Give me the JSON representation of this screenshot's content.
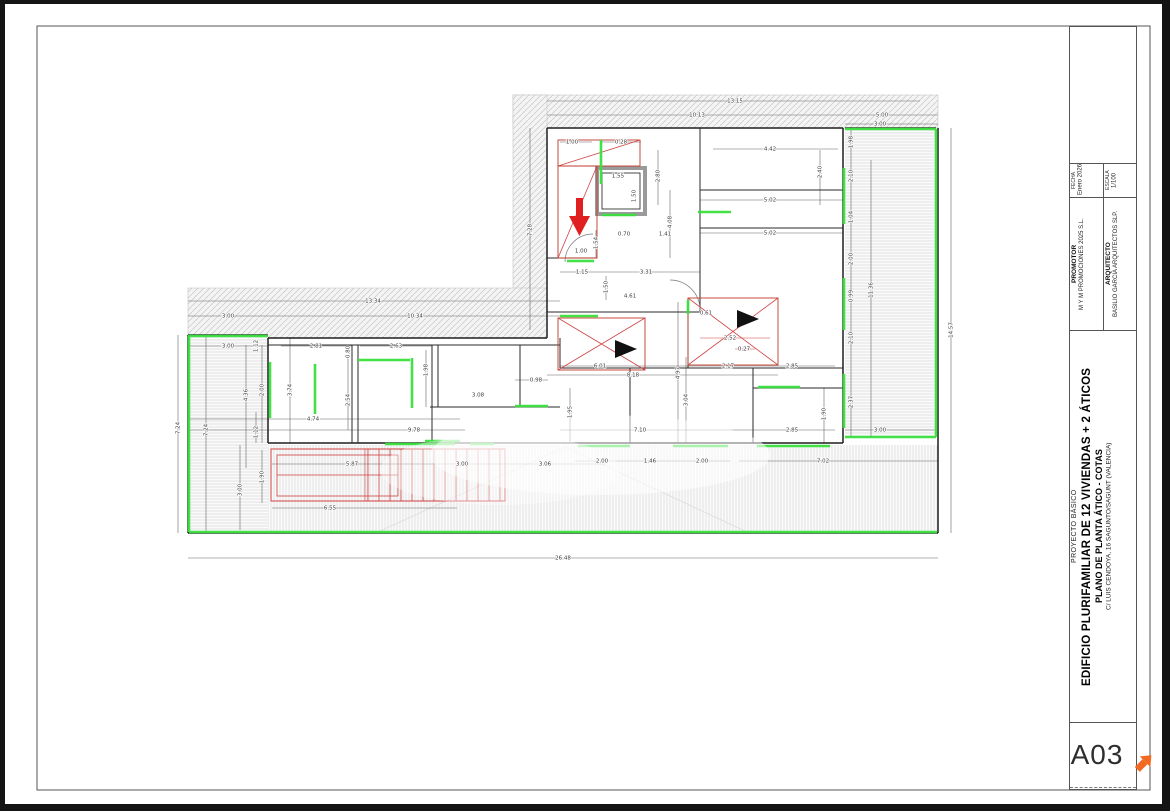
{
  "page": {
    "background": "#ffffff",
    "margin_color": "#141414",
    "frame_color": "#555555"
  },
  "title_block": {
    "fecha_label": "FECHA",
    "fecha_value": "Enero 2026",
    "escala_label": "ESCALA",
    "escala_value": "1/100",
    "promotor_label": "PROMOTOR",
    "promotor_value": "M Y M PROMOCIONES 2025 S.L.",
    "arquitecto_label": "ARQUITECTO",
    "arquitecto_value": "BASILIO GARCIA ARQUITECTOS SLP.",
    "proyecto_tipo": "PROYECTO BÁSICO",
    "proyecto_titulo": "EDIFICIO PLURIFAMILIAR DE 12 VIVIENDAS + 2 ÁTICOS",
    "plano_titulo": "PLANO DE PLANTA ÁTICO - COTAS",
    "direccion": "C/ LUIS CENDOYA, 16 SAGUNTO/SAGUNT (VALENCIA)",
    "sheet_number": "A03",
    "logo_color": "#f26a21"
  },
  "drawing": {
    "colors": {
      "highlight_green": "#38e03c",
      "stair_red": "#d04545",
      "arrow_red": "#e02020",
      "walls": "#1f1f1f",
      "hatch": "#cfcfcf"
    },
    "dimensions": [
      [
        735,
        101,
        "13.15",
        0
      ],
      [
        697,
        115,
        "10.13",
        0
      ],
      [
        882,
        115,
        "5.00",
        0
      ],
      [
        880,
        124,
        "3.00",
        0
      ],
      [
        530,
        230,
        "7.28",
        1
      ],
      [
        572,
        142,
        "1.00",
        0
      ],
      [
        621,
        142,
        "0.28",
        0
      ],
      [
        618,
        176,
        "1.55",
        0
      ],
      [
        634,
        196,
        "1.50",
        1
      ],
      [
        658,
        176,
        "2.80",
        1
      ],
      [
        670,
        222,
        "4.08",
        1
      ],
      [
        596,
        243,
        "1.54",
        1
      ],
      [
        581,
        251,
        "1.00",
        0
      ],
      [
        582,
        272,
        "1.15",
        0
      ],
      [
        646,
        272,
        "3.31",
        0
      ],
      [
        606,
        287,
        "1.50",
        1
      ],
      [
        630,
        296,
        "4.61",
        0
      ],
      [
        624,
        234,
        "0.70",
        0
      ],
      [
        665,
        234,
        "1.41",
        0
      ],
      [
        770,
        149,
        "4.42",
        0
      ],
      [
        770,
        200,
        "5.02",
        0
      ],
      [
        770,
        233,
        "5.02",
        0
      ],
      [
        820,
        172,
        "2.40",
        1
      ],
      [
        851,
        142,
        "1.98",
        1
      ],
      [
        851,
        176,
        "2.10",
        1
      ],
      [
        851,
        217,
        "1.04",
        1
      ],
      [
        851,
        259,
        "2.00",
        1
      ],
      [
        851,
        296,
        "0.99",
        1
      ],
      [
        851,
        338,
        "2.10",
        1
      ],
      [
        851,
        402,
        "2.37",
        1
      ],
      [
        871,
        290,
        "11.36",
        1
      ],
      [
        951,
        330,
        "14.57",
        1
      ],
      [
        880,
        430,
        "3.00",
        0
      ],
      [
        373,
        301,
        "13.34",
        0
      ],
      [
        228,
        316,
        "3.00",
        0
      ],
      [
        415,
        316,
        "10.34",
        0
      ],
      [
        228,
        346,
        "3.00",
        0
      ],
      [
        256,
        346,
        "1.12",
        1
      ],
      [
        316,
        346,
        "2.81",
        0
      ],
      [
        348,
        352,
        "0.80",
        1
      ],
      [
        396,
        346,
        "2.63",
        0
      ],
      [
        178,
        428,
        "7.24",
        1
      ],
      [
        206,
        430,
        "7.24",
        1
      ],
      [
        246,
        395,
        "4.36",
        1
      ],
      [
        262,
        390,
        "2.00",
        1
      ],
      [
        290,
        390,
        "3.74",
        1
      ],
      [
        348,
        400,
        "2.54",
        1
      ],
      [
        313,
        419,
        "4.74",
        0
      ],
      [
        414,
        430,
        "9.78",
        0
      ],
      [
        256,
        432,
        "1.12",
        1
      ],
      [
        262,
        477,
        "1.90",
        1
      ],
      [
        240,
        490,
        "3.00",
        1
      ],
      [
        352,
        464,
        "5.87",
        0
      ],
      [
        462,
        464,
        "3.00",
        0
      ],
      [
        545,
        464,
        "3.06",
        0
      ],
      [
        330,
        508,
        "6.55",
        0
      ],
      [
        563,
        558,
        "26.48",
        0
      ],
      [
        600,
        366,
        "6.01",
        0
      ],
      [
        728,
        366,
        "2.17",
        0
      ],
      [
        633,
        375,
        "8.18",
        0
      ],
      [
        678,
        373,
        "4.97",
        1
      ],
      [
        686,
        400,
        "3.04",
        1
      ],
      [
        570,
        412,
        "1.95",
        1
      ],
      [
        640,
        430,
        "7.10",
        0
      ],
      [
        536,
        380,
        "0.98",
        0
      ],
      [
        478,
        395,
        "3.08",
        0
      ],
      [
        426,
        370,
        "1.98",
        1
      ],
      [
        792,
        366,
        "2.85",
        0
      ],
      [
        792,
        430,
        "2.85",
        0
      ],
      [
        824,
        414,
        "1.90",
        1
      ],
      [
        730,
        338,
        "2.52",
        0
      ],
      [
        744,
        349,
        "0.27",
        0
      ],
      [
        706,
        313,
        "0.61",
        0
      ],
      [
        602,
        461,
        "2.00",
        0
      ],
      [
        650,
        461,
        "1.46",
        0
      ],
      [
        702,
        461,
        "2.00",
        0
      ],
      [
        823,
        461,
        "7.02",
        0
      ]
    ]
  }
}
